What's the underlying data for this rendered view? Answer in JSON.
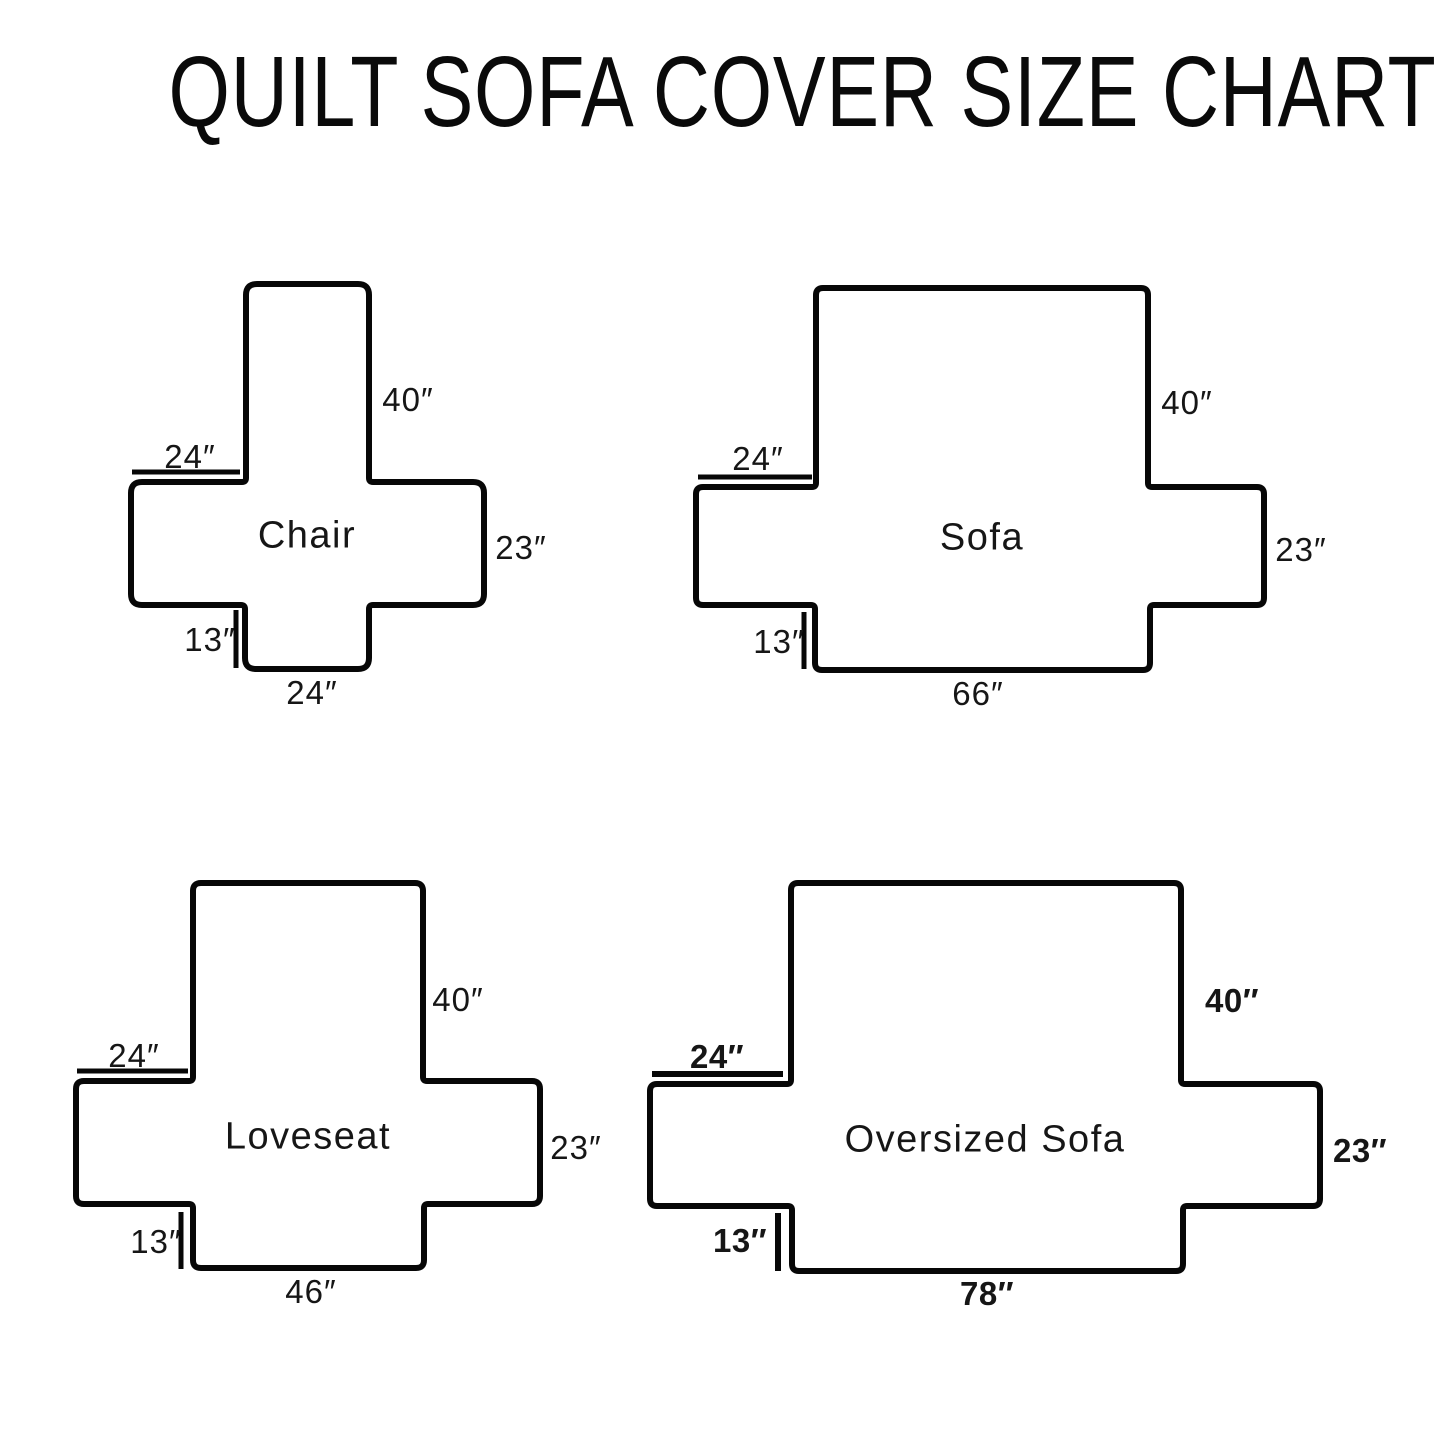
{
  "title": "QUILT SOFA COVER SIZE CHART",
  "panels": [
    {
      "name": "Chair",
      "back_height": "40″",
      "arm_top_width": "24″",
      "arm_side_height": "23″",
      "front_skirt_drop": "13″",
      "seat_front_width": "24″"
    },
    {
      "name": "Sofa",
      "back_height": "40″",
      "arm_top_width": "24″",
      "arm_side_height": "23″",
      "front_skirt_drop": "13″",
      "seat_front_width": "66″"
    },
    {
      "name": "Loveseat",
      "back_height": "40″",
      "arm_top_width": "24″",
      "arm_side_height": "23″",
      "front_skirt_drop": "13″",
      "seat_front_width": "46″"
    },
    {
      "name": "Oversized Sofa",
      "back_height": "40″",
      "arm_top_width": "24″",
      "arm_side_height": "23″",
      "front_skirt_drop": "13″",
      "seat_front_width": "78″"
    }
  ],
  "colors": {
    "background": "#ffffff",
    "line": "#070707",
    "text": "#161616"
  }
}
